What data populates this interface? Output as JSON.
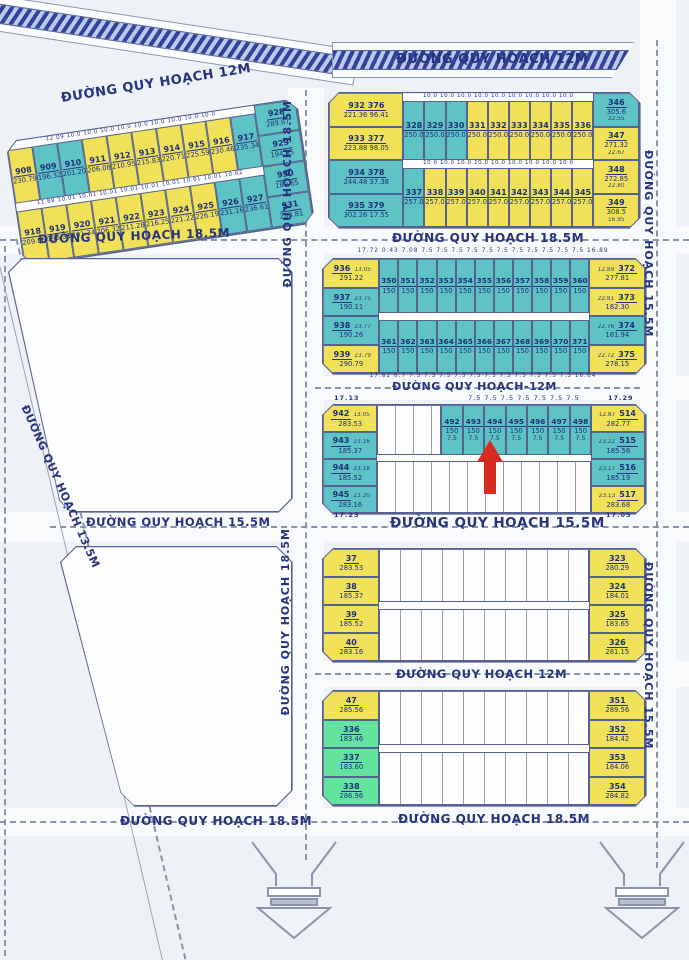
{
  "palette": {
    "yellow": "#f1e159",
    "teal": "#5ec3c5",
    "green": "#62e49f",
    "arrow_red": "#d92a1f",
    "text_navy": "#1e2f7a"
  },
  "roads": [
    {
      "text": "ĐƯỜNG QUY HOẠCH 12M"
    },
    {
      "text": "ĐƯỜNG QUY HOẠCH 12M"
    },
    {
      "text": "ĐƯỜNG QUY HOẠCH 18.5M"
    },
    {
      "text": "ĐƯỜNG QUY HOẠCH 18.5M"
    },
    {
      "text": "ĐƯỜNG QUY HOẠCH 18.5M"
    },
    {
      "text": "ĐƯỜNG QUY HOẠCH 18.5M"
    },
    {
      "text": "ĐƯỜNG QUY HOẠCH 15.5M"
    },
    {
      "text": "ĐƯỜNG QUY HOẠCH 15.5M"
    },
    {
      "text": "ĐƯỜNG QUY HOẠCH-12M"
    },
    {
      "text": "ĐƯỜNG QUY HOẠCH 15.5M"
    },
    {
      "text": "ĐƯỜNG QUY HOẠCH 15.5M"
    },
    {
      "text": "ĐƯỜNG QUY HOẠCH 12M"
    },
    {
      "text": "ĐƯỜNG QUY HOẠCH 18.5M"
    },
    {
      "text": "ĐƯỜNG QUY HOẠCH 18.5M"
    },
    {
      "text": "ĐƯỜNG QUY HOẠCH 13.5M"
    }
  ],
  "blockA": {
    "dims1": "12.09 10.0 10.0 10.0 10.0 10.0 10.0 10.0 10.0 10.0",
    "dims2": "11.88 10.01 10.01 10.01 10.01 10.01 10.01 10.01 10.01 10.02",
    "row1": [
      {
        "n": "908",
        "a": "230.79",
        "c": "y"
      },
      {
        "n": "909",
        "a": "196.32",
        "c": "t"
      },
      {
        "n": "910",
        "a": "201.20",
        "c": "t"
      },
      {
        "n": "911",
        "a": "206.08",
        "c": "y"
      },
      {
        "n": "912",
        "a": "210.95",
        "c": "y"
      },
      {
        "n": "913",
        "a": "215.83",
        "c": "y"
      },
      {
        "n": "914",
        "a": "220.71",
        "c": "y"
      },
      {
        "n": "915",
        "a": "225.59",
        "c": "y"
      },
      {
        "n": "916",
        "a": "230.46",
        "c": "y"
      },
      {
        "n": "917",
        "a": "235.34",
        "c": "t"
      }
    ],
    "row2": [
      {
        "n": "918",
        "a": "209.06",
        "c": "y"
      },
      {
        "n": "919",
        "a": "196.38",
        "c": "y"
      },
      {
        "n": "920",
        "a": "201.34",
        "c": "y"
      },
      {
        "n": "921",
        "a": "206.32",
        "c": "y"
      },
      {
        "n": "922",
        "a": "211.28",
        "c": "y"
      },
      {
        "n": "923",
        "a": "216.25",
        "c": "y"
      },
      {
        "n": "924",
        "a": "221.22",
        "c": "y"
      },
      {
        "n": "925",
        "a": "226.19",
        "c": "y"
      },
      {
        "n": "926",
        "a": "231.16",
        "c": "t"
      },
      {
        "n": "927",
        "a": "236.61",
        "c": "t"
      }
    ],
    "col": [
      {
        "n": "928",
        "a": "289.87",
        "c": "t"
      },
      {
        "n": "929",
        "a": "194.85",
        "c": "t"
      },
      {
        "n": "930",
        "a": "189.65",
        "c": "t"
      },
      {
        "n": "931",
        "a": "283.81",
        "c": "t"
      }
    ]
  },
  "blockB": {
    "dims1": "10.0 10.0 10.0 10.0 10.0 10.0 10.0 10.0 10.0",
    "dims2": "10.0 10.0 10.0 10.0 10.0 10.0 10.0 10.0 10.0",
    "left": [
      {
        "n": "932 376",
        "a": "221.36 96.41",
        "c": "y"
      },
      {
        "n": "933 377",
        "a": "223.88 98.05",
        "c": "y"
      },
      {
        "n": "934 378",
        "a": "244.48 37.38",
        "c": "t"
      },
      {
        "n": "935 379",
        "a": "302.26 17.55",
        "c": "t"
      }
    ],
    "row1": [
      {
        "n": "328",
        "a": "250.0",
        "c": "t"
      },
      {
        "n": "329",
        "a": "250.0",
        "c": "t"
      },
      {
        "n": "330",
        "a": "250.0",
        "c": "t"
      },
      {
        "n": "331",
        "a": "250.0",
        "c": "y"
      },
      {
        "n": "332",
        "a": "250.0",
        "c": "y"
      },
      {
        "n": "333",
        "a": "250.0",
        "c": "y"
      },
      {
        "n": "334",
        "a": "250.0",
        "c": "y"
      },
      {
        "n": "335",
        "a": "250.0",
        "c": "y"
      },
      {
        "n": "336",
        "a": "250.0",
        "c": "y"
      }
    ],
    "row2": [
      {
        "n": "337",
        "a": "257.0",
        "c": "t"
      },
      {
        "n": "338",
        "a": "257.0",
        "c": "y"
      },
      {
        "n": "339",
        "a": "257.0",
        "c": "y"
      },
      {
        "n": "340",
        "a": "257.0",
        "c": "y"
      },
      {
        "n": "341",
        "a": "257.0",
        "c": "y"
      },
      {
        "n": "342",
        "a": "257.0",
        "c": "y"
      },
      {
        "n": "343",
        "a": "257.0",
        "c": "y"
      },
      {
        "n": "344",
        "a": "257.0",
        "c": "y"
      },
      {
        "n": "345",
        "a": "257.0",
        "c": "y"
      }
    ],
    "right": [
      {
        "n": "346",
        "a": "305.6",
        "d": "22.55",
        "c": "t"
      },
      {
        "n": "347",
        "a": "271.32",
        "d": "22.67",
        "c": "y"
      },
      {
        "n": "348",
        "a": "272.85",
        "d": "22.80",
        "c": "y"
      },
      {
        "n": "349",
        "a": "308.5",
        "d": "16.95",
        "c": "y"
      }
    ]
  },
  "blockC": {
    "dims_top": "17.72 0.43 7.08 7.5 7.5 7.5 7.5 7.5 7.5 7.5 7.5 7.5 7.5 7.5 16.89",
    "dims_bottom": "17.82 6.7 7.5 7.5 7.5 7.5 7.5 7.5 7.5 7.5 7.5 7.5 7.5 16.64",
    "left": [
      {
        "n": "936",
        "a": "291.22",
        "d": "13.05",
        "c": "y"
      },
      {
        "n": "937",
        "a": "190.11",
        "d": "23.75",
        "c": "t"
      },
      {
        "n": "938",
        "a": "190.26",
        "d": "23.77",
        "c": "t"
      },
      {
        "n": "939",
        "a": "290.79",
        "d": "23.79",
        "c": "y"
      }
    ],
    "row1": [
      {
        "n": "350",
        "a": "150",
        "c": "t"
      },
      {
        "n": "351",
        "a": "150",
        "c": "t"
      },
      {
        "n": "352",
        "a": "150",
        "c": "t"
      },
      {
        "n": "353",
        "a": "150",
        "c": "t"
      },
      {
        "n": "354",
        "a": "150",
        "c": "t"
      },
      {
        "n": "355",
        "a": "150",
        "c": "t"
      },
      {
        "n": "356",
        "a": "150",
        "c": "t"
      },
      {
        "n": "357",
        "a": "150",
        "c": "t"
      },
      {
        "n": "358",
        "a": "150",
        "c": "t"
      },
      {
        "n": "359",
        "a": "150",
        "c": "t"
      },
      {
        "n": "360",
        "a": "150",
        "c": "t"
      }
    ],
    "row2": [
      {
        "n": "361",
        "a": "150",
        "c": "t"
      },
      {
        "n": "362",
        "a": "150",
        "c": "t"
      },
      {
        "n": "363",
        "a": "150",
        "c": "t"
      },
      {
        "n": "364",
        "a": "150",
        "c": "t"
      },
      {
        "n": "365",
        "a": "150",
        "c": "t"
      },
      {
        "n": "366",
        "a": "150",
        "c": "t"
      },
      {
        "n": "367",
        "a": "150",
        "c": "t"
      },
      {
        "n": "368",
        "a": "150",
        "c": "t"
      },
      {
        "n": "369",
        "a": "150",
        "c": "t"
      },
      {
        "n": "370",
        "a": "150",
        "c": "t"
      },
      {
        "n": "371",
        "a": "150",
        "c": "t"
      }
    ],
    "right": [
      {
        "n": "372",
        "a": "277.81",
        "d": "12.89",
        "c": "y"
      },
      {
        "n": "373",
        "a": "182.30",
        "d": "22.81",
        "c": "y"
      },
      {
        "n": "374",
        "a": "181.94",
        "d": "22.76",
        "c": "t"
      },
      {
        "n": "375",
        "a": "278.15",
        "d": "22.72",
        "c": "y"
      }
    ]
  },
  "blockD": {
    "dims": {
      "tl": "17.13",
      "tc": "7.5 7.5 7.5 7.5 7.5 7.5 7.5",
      "tr": "17.29",
      "bl": "17.23",
      "br": "17.05"
    },
    "left": [
      {
        "n": "942",
        "a": "283.53",
        "d": "13.05",
        "c": "y"
      },
      {
        "n": "943",
        "a": "185.37",
        "d": "23.16",
        "c": "t"
      },
      {
        "n": "944",
        "a": "185.52",
        "d": "23.18",
        "c": "t"
      },
      {
        "n": "945",
        "a": "283.16",
        "d": "23.20",
        "c": "t"
      }
    ],
    "teal": [
      {
        "n": "492",
        "a": "150",
        "f": "7.5",
        "c": "t"
      },
      {
        "n": "493",
        "a": "150",
        "f": "7.5",
        "c": "t"
      },
      {
        "n": "494",
        "a": "150",
        "f": "7.5",
        "c": "t"
      },
      {
        "n": "495",
        "a": "150",
        "f": "7.5",
        "c": "t"
      },
      {
        "n": "496",
        "a": "150",
        "f": "7.5",
        "c": "t"
      },
      {
        "n": "497",
        "a": "150",
        "f": "7.5",
        "c": "t"
      },
      {
        "n": "498",
        "a": "150",
        "f": "7.5",
        "c": "t"
      }
    ],
    "right": [
      {
        "n": "514",
        "a": "282.77",
        "d": "12.87",
        "c": "y"
      },
      {
        "n": "515",
        "a": "185.56",
        "d": "23.22",
        "c": "t"
      },
      {
        "n": "516",
        "a": "185.19",
        "d": "23.17",
        "c": "t"
      },
      {
        "n": "517",
        "a": "283.68",
        "d": "23.13",
        "c": "y"
      }
    ]
  },
  "blockE": {
    "left": [
      {
        "n": "37",
        "a": "283.53",
        "c": "y"
      },
      {
        "n": "38",
        "a": "185.37",
        "c": "y"
      },
      {
        "n": "39",
        "a": "185.52",
        "c": "y"
      },
      {
        "n": "40",
        "a": "283.16",
        "c": "y"
      }
    ],
    "right": [
      {
        "n": "323",
        "a": "280.29",
        "c": "y"
      },
      {
        "n": "324",
        "a": "184.01",
        "c": "y"
      },
      {
        "n": "325",
        "a": "183.65",
        "c": "y"
      },
      {
        "n": "326",
        "a": "281.15",
        "c": "y"
      }
    ]
  },
  "blockF": {
    "left": [
      {
        "n": "47",
        "a": "285.56",
        "c": "y"
      },
      {
        "n": "336",
        "a": "183.46",
        "c": "g"
      },
      {
        "n": "337",
        "a": "183.60",
        "c": "g"
      },
      {
        "n": "338",
        "a": "286.96",
        "c": "g"
      }
    ],
    "right": [
      {
        "n": "351",
        "a": "289.56",
        "c": "y"
      },
      {
        "n": "352",
        "a": "184.42",
        "c": "y"
      },
      {
        "n": "353",
        "a": "184.06",
        "c": "y"
      },
      {
        "n": "354",
        "a": "284.82",
        "c": "y"
      }
    ]
  }
}
